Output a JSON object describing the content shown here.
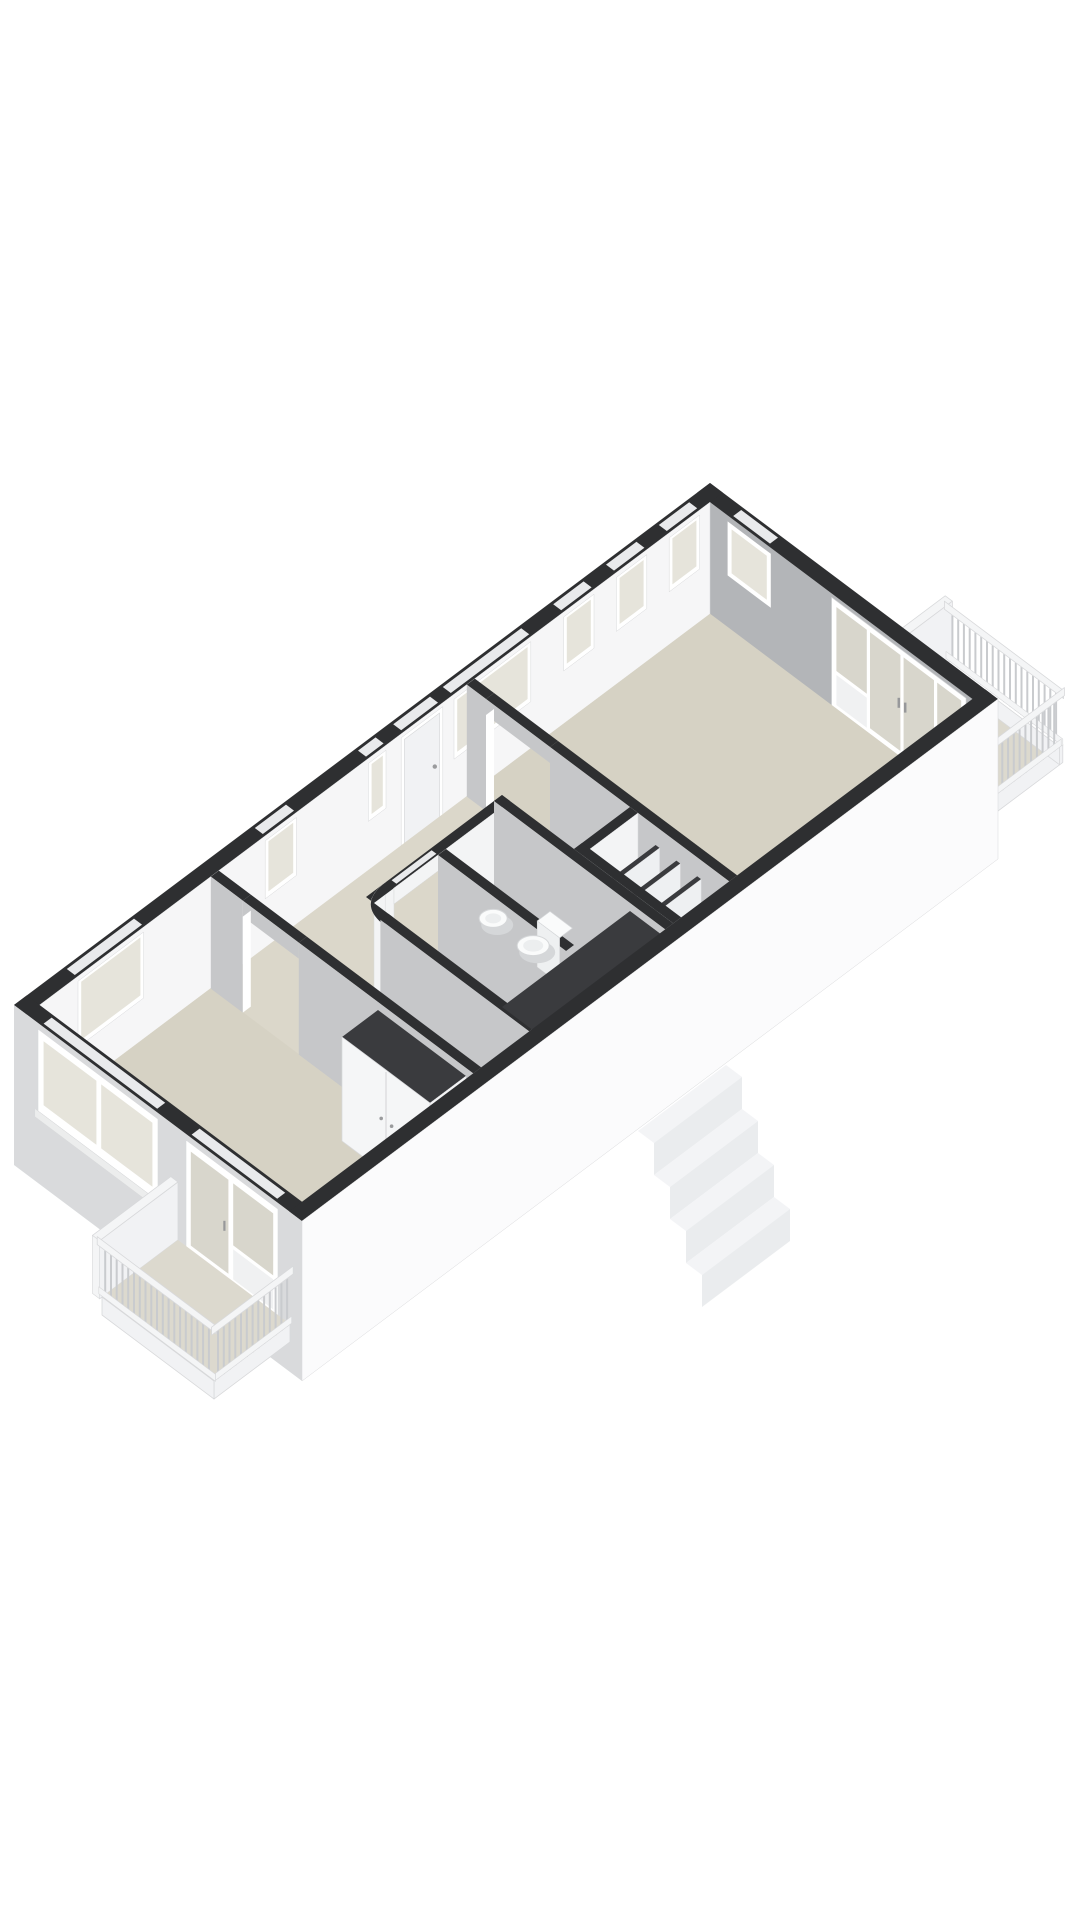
{
  "palette": {
    "background": "#ffffff",
    "wallTop": "#2e2f31",
    "wallTopSoft": "#3a3b3e",
    "nwInner": "#f6f6f7",
    "neInner": "#b3b5b8",
    "intGray": "#c6c7c9",
    "intGrayDark": "#b8b9bc",
    "intWhite": "#f3f4f5",
    "closetWhite": "#f5f6f7",
    "shelfWhite": "#eef0f2",
    "swFacade": "#d9dadc",
    "seFacade": "#fbfbfc",
    "floorMain": "#d6d2c4",
    "floorHall": "#dbd7ca",
    "floorBath": "#e3e3e4",
    "balconyFloor": "#dcd9ce",
    "glass": "#e6e4db",
    "glassDoor": "#d8d6cc",
    "frameWhite": "#ffffff",
    "slotLight": "#e9eaec",
    "railWhite": "#f4f5f6",
    "railSlat": "#c9cbce",
    "slabWhite": "#f1f2f4",
    "stairTop": "#f2f3f5",
    "stairRiser": "#e9ebed",
    "edge": "#d8d9db",
    "fixtureWhite": "#fafbfb",
    "fixtureShadow": "#d5d7d9",
    "fixtureInner": "#eceeef"
  },
  "scene": {
    "type": "isometric-3d-floorplan",
    "rooms": [
      "living-room",
      "hall",
      "bathroom",
      "toilet-room",
      "storage-closet",
      "bedroom"
    ],
    "balconies": [
      "living-room-balcony",
      "bedroom-balcony"
    ],
    "fixtures": [
      "washbasin",
      "toilet",
      "wardrobe",
      "shelving"
    ],
    "openings": [
      "entry-door",
      "nw-windows",
      "ne-glazed-doors",
      "sw-window",
      "sw-glazed-door"
    ],
    "exterior": [
      "railings",
      "exterior-stairs"
    ]
  }
}
